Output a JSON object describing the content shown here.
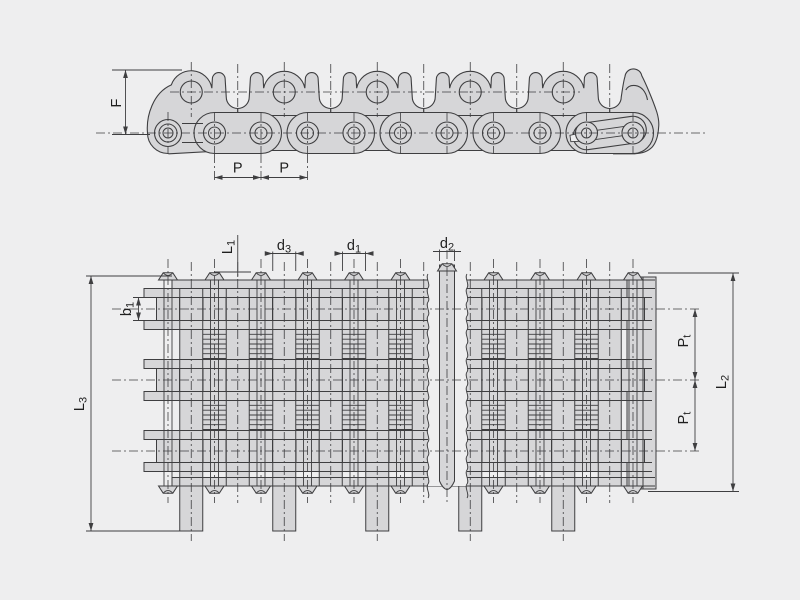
{
  "drawing": {
    "background": "#eeeeef",
    "line_color": "#3e3e40",
    "plate_fill": "#d6d6d8",
    "gap_fill": "#f1f1f2",
    "text_color": "#1f1f1f",
    "description": "Roller chain engineering drawing, side elevation above and sectioned plan view below"
  },
  "top_view": {
    "dims": {
      "f": "F",
      "p_left": "P",
      "p_right": "P"
    }
  },
  "bottom_view": {
    "dims": {
      "l1_main": "L",
      "l1_sub": "1",
      "d3_main": "d",
      "d3_sub": "3",
      "d1_main": "d",
      "d1_sub": "1",
      "d2_main": "d",
      "d2_sub": "2",
      "b1_main": "b",
      "b1_sub": "1",
      "l3_main": "L",
      "l3_sub": "3",
      "pt_upper_main": "P",
      "pt_upper_sub": "t",
      "pt_lower_main": "P",
      "pt_lower_sub": "t",
      "l2_main": "L",
      "l2_sub": "2"
    }
  }
}
